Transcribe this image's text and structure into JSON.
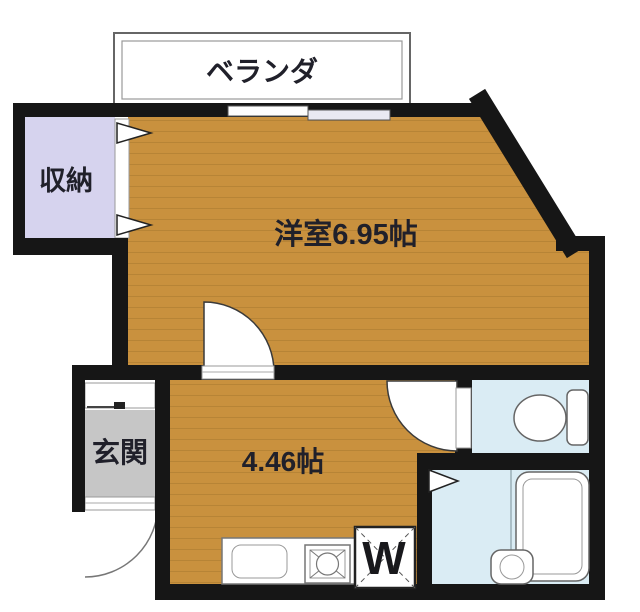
{
  "labels": {
    "balcony": "ベランダ",
    "closet": "収納",
    "western_room": "洋室6.95帖",
    "entrance": "玄関",
    "kitchen_room": "4.46帖",
    "washer": "W"
  },
  "colors": {
    "wall": "#161616",
    "wood_floor": "#c9913e",
    "wood_plank_line": "#a87a2e",
    "closet_fill": "#d6d3ee",
    "entrance_floor": "#c6c6c6",
    "wet_area_fill": "#daecf4",
    "fixture_outline": "#666666",
    "background": "#ffffff"
  }
}
